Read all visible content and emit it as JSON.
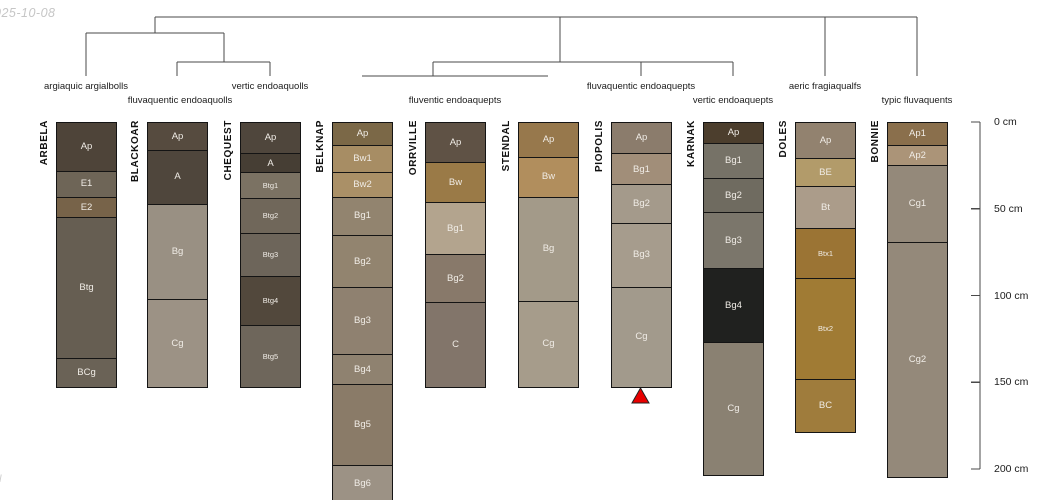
{
  "page": {
    "date_stamp": "025-10-08",
    "corner_mark": "ll"
  },
  "colors": {
    "line": "#4a4a4a",
    "border": "#141414",
    "horizon_label": "#f0ece6",
    "marker_red": "#e80000"
  },
  "dendrogram": {
    "segments": [
      [
        155,
        17,
        917,
        17
      ],
      [
        155,
        17,
        155,
        33
      ],
      [
        86,
        33,
        224,
        33
      ],
      [
        86,
        33,
        86,
        76
      ],
      [
        224,
        33,
        224,
        62
      ],
      [
        177,
        62,
        270,
        62
      ],
      [
        177,
        62,
        177,
        76
      ],
      [
        270,
        62,
        270,
        76
      ],
      [
        560,
        17,
        560,
        62
      ],
      [
        433,
        62,
        733,
        62
      ],
      [
        433,
        62,
        433,
        76
      ],
      [
        362,
        76,
        548,
        76
      ],
      [
        641,
        62,
        641,
        76
      ],
      [
        733,
        62,
        733,
        76
      ],
      [
        825,
        17,
        825,
        76
      ],
      [
        917,
        17,
        917,
        76
      ]
    ],
    "taxa": [
      {
        "label": "argiaquic argialbolls",
        "x": 86,
        "y": 81
      },
      {
        "label": "fluvaquentic endoaquolls",
        "x": 180,
        "y": 95
      },
      {
        "label": "vertic endoaquolls",
        "x": 270,
        "y": 81
      },
      {
        "label": "fluventic endoaquepts",
        "x": 455,
        "y": 95
      },
      {
        "label": "fluvaquentic endoaquepts",
        "x": 641,
        "y": 81
      },
      {
        "label": "vertic endoaquepts",
        "x": 733,
        "y": 95
      },
      {
        "label": "aeric fragiaqualfs",
        "x": 825,
        "y": 81
      },
      {
        "label": "typic fluvaquents",
        "x": 917,
        "y": 95
      }
    ]
  },
  "scale": {
    "zero_y": 122,
    "px_per_cm": 1.735,
    "axis_x": 980,
    "tick_len": 9,
    "label_x": 994,
    "ticks": [
      {
        "cm": 0,
        "label": "0 cm"
      },
      {
        "cm": 50,
        "label": "50 cm"
      },
      {
        "cm": 100,
        "label": "100 cm"
      },
      {
        "cm": 150,
        "label": "150 cm"
      },
      {
        "cm": 200,
        "label": "200 cm"
      }
    ]
  },
  "marker": {
    "type": "triangle-up",
    "profile": "PIOPOLIS",
    "x": 640.5,
    "y": 388,
    "half_width": 8.5,
    "height": 15,
    "fill": "#e80000",
    "stroke": "#222222"
  },
  "profiles": [
    {
      "name": "ARBELA",
      "x": 86,
      "horizons": [
        {
          "label": "Ap",
          "base_cm": 28,
          "color": "#4e4439"
        },
        {
          "label": "E1",
          "base_cm": 43,
          "color": "#6e6557"
        },
        {
          "label": "E2",
          "base_cm": 55,
          "color": "#776349"
        },
        {
          "label": "Btg",
          "base_cm": 136,
          "color": "#665e52"
        },
        {
          "label": "BCg",
          "base_cm": 152,
          "color": "#6a6256"
        }
      ]
    },
    {
      "name": "BLACKOAR",
      "x": 177,
      "horizons": [
        {
          "label": "Ap",
          "base_cm": 16,
          "color": "#564b3f"
        },
        {
          "label": "A",
          "base_cm": 47,
          "color": "#4f463c"
        },
        {
          "label": "Bg",
          "base_cm": 102,
          "color": "#999083"
        },
        {
          "label": "Cg",
          "base_cm": 152,
          "color": "#9c9285"
        }
      ]
    },
    {
      "name": "CHEQUEST",
      "x": 270,
      "horizons": [
        {
          "label": "Ap",
          "base_cm": 18,
          "color": "#4f463c"
        },
        {
          "label": "A",
          "base_cm": 29,
          "color": "#463e34"
        },
        {
          "label": "Btg1",
          "base_cm": 44,
          "color": "#7b7263",
          "small": true
        },
        {
          "label": "Btg2",
          "base_cm": 64,
          "color": "#70675a",
          "small": true
        },
        {
          "label": "Btg3",
          "base_cm": 89,
          "color": "#6d655a",
          "small": true
        },
        {
          "label": "Btg4",
          "base_cm": 117,
          "color": "#52483c",
          "small": true
        },
        {
          "label": "Btg5",
          "base_cm": 152,
          "color": "#6e665b",
          "small": true
        }
      ]
    },
    {
      "name": "BELKNAP",
      "x": 362,
      "horizons": [
        {
          "label": "Ap",
          "base_cm": 13,
          "color": "#7b6847"
        },
        {
          "label": "Bw1",
          "base_cm": 29,
          "color": "#a78d64"
        },
        {
          "label": "Bw2",
          "base_cm": 43,
          "color": "#aa9067"
        },
        {
          "label": "Bg1",
          "base_cm": 65,
          "color": "#92846f"
        },
        {
          "label": "Bg2",
          "base_cm": 95,
          "color": "#92846f"
        },
        {
          "label": "Bg3",
          "base_cm": 134,
          "color": "#8f8170"
        },
        {
          "label": "Bg4",
          "base_cm": 151,
          "color": "#8f8270"
        },
        {
          "label": "Bg5",
          "base_cm": 198,
          "color": "#8a7b68"
        },
        {
          "label": "Bg6",
          "base_cm": 218,
          "color": "#9c9285"
        }
      ]
    },
    {
      "name": "ORRVILLE",
      "x": 455,
      "horizons": [
        {
          "label": "Ap",
          "base_cm": 23,
          "color": "#5f5245"
        },
        {
          "label": "Bw",
          "base_cm": 46,
          "color": "#9a7a47"
        },
        {
          "label": "Bg1",
          "base_cm": 76,
          "color": "#b3a48e"
        },
        {
          "label": "Bg2",
          "base_cm": 104,
          "color": "#88796a"
        },
        {
          "label": "C",
          "base_cm": 152,
          "color": "#82756a"
        }
      ]
    },
    {
      "name": "STENDAL",
      "x": 548,
      "horizons": [
        {
          "label": "Ap",
          "base_cm": 20,
          "color": "#97784c"
        },
        {
          "label": "Bw",
          "base_cm": 43,
          "color": "#b18e5d"
        },
        {
          "label": "Bg",
          "base_cm": 103,
          "color": "#a39a89"
        },
        {
          "label": "Cg",
          "base_cm": 152,
          "color": "#a69c8b"
        }
      ]
    },
    {
      "name": "PIOPOLIS",
      "x": 641,
      "horizons": [
        {
          "label": "Ap",
          "base_cm": 18,
          "color": "#8b7c6c"
        },
        {
          "label": "Bg1",
          "base_cm": 36,
          "color": "#a18e79"
        },
        {
          "label": "Bg2",
          "base_cm": 58,
          "color": "#a49a8b"
        },
        {
          "label": "Bg3",
          "base_cm": 95,
          "color": "#a69c8d"
        },
        {
          "label": "Cg",
          "base_cm": 152,
          "color": "#a29a8c"
        }
      ]
    },
    {
      "name": "KARNAK",
      "x": 733,
      "horizons": [
        {
          "label": "Ap",
          "base_cm": 12,
          "color": "#4c3e2d"
        },
        {
          "label": "Bg1",
          "base_cm": 32,
          "color": "#767267"
        },
        {
          "label": "Bg2",
          "base_cm": 52,
          "color": "#6f6b60"
        },
        {
          "label": "Bg3",
          "base_cm": 84,
          "color": "#7b766b"
        },
        {
          "label": "Bg4",
          "base_cm": 127,
          "color": "#20211f"
        },
        {
          "label": "Cg",
          "base_cm": 203,
          "color": "#8a8172"
        }
      ]
    },
    {
      "name": "DOLES",
      "x": 825,
      "horizons": [
        {
          "label": "Ap",
          "base_cm": 21,
          "color": "#92826f"
        },
        {
          "label": "BE",
          "base_cm": 37,
          "color": "#b29b6a"
        },
        {
          "label": "Bt",
          "base_cm": 61,
          "color": "#ab9c8a"
        },
        {
          "label": "Btx1",
          "base_cm": 90,
          "color": "#9b7434",
          "small": true
        },
        {
          "label": "Btx2",
          "base_cm": 148,
          "color": "#a07b34",
          "small": true
        },
        {
          "label": "BC",
          "base_cm": 178,
          "color": "#9f7c3c"
        }
      ]
    },
    {
      "name": "BONNIE",
      "x": 917,
      "horizons": [
        {
          "label": "Ap1",
          "base_cm": 13,
          "color": "#8a6f4c"
        },
        {
          "label": "Ap2",
          "base_cm": 25,
          "color": "#ab9478"
        },
        {
          "label": "Cg1",
          "base_cm": 69,
          "color": "#94897a"
        },
        {
          "label": "Cg2",
          "base_cm": 204,
          "color": "#94897a"
        }
      ]
    }
  ]
}
